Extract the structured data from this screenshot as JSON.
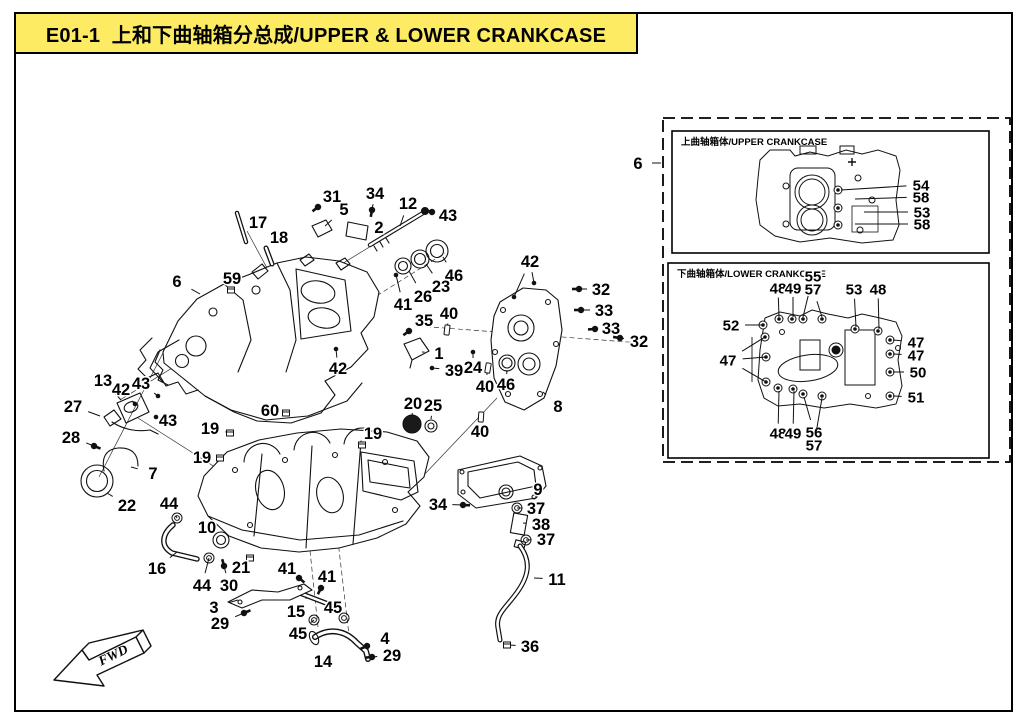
{
  "page": {
    "title": "E01-1  上和下曲轴箱分总成/UPPER & LOWER CRANKCASE",
    "fwd_label": "FWD",
    "colors": {
      "title_bg": "#fdec63",
      "line": "#000000",
      "paper": "#ffffff"
    }
  },
  "main_callouts": [
    {
      "n": "31",
      "x": 332,
      "y": 196,
      "t": [
        [
          318,
          207
        ]
      ],
      "g": "bolt"
    },
    {
      "n": "34",
      "x": 375,
      "y": 193,
      "t": [
        [
          372,
          210
        ]
      ],
      "g": "bolt"
    },
    {
      "n": "12",
      "x": 408,
      "y": 203,
      "t": [
        [
          400,
          226
        ]
      ],
      "g": "none"
    },
    {
      "n": "43",
      "x": 448,
      "y": 215,
      "t": [
        [
          432,
          212
        ]
      ],
      "g": "bolt"
    },
    {
      "n": "5",
      "x": 344,
      "y": 209,
      "t": [
        [
          325,
          226
        ]
      ],
      "g": "none"
    },
    {
      "n": "2",
      "x": 379,
      "y": 227,
      "t": [
        [
          367,
          230
        ]
      ],
      "g": "none"
    },
    {
      "n": "17",
      "x": 258,
      "y": 222,
      "t": [
        [
          247,
          222
        ]
      ],
      "g": "none"
    },
    {
      "n": "18",
      "x": 279,
      "y": 237,
      "t": [
        [
          272,
          250
        ]
      ],
      "g": "none"
    },
    {
      "n": "59",
      "x": 232,
      "y": 278,
      "t": [
        [
          231,
          290
        ]
      ],
      "g": "plug"
    },
    {
      "n": "6",
      "x": 177,
      "y": 281,
      "t": [
        [
          200,
          294
        ]
      ],
      "g": "none"
    },
    {
      "n": "46",
      "x": 454,
      "y": 275,
      "t": [
        [
          443,
          257
        ]
      ],
      "g": "none"
    },
    {
      "n": "23",
      "x": 441,
      "y": 286,
      "t": [
        [
          426,
          264
        ]
      ],
      "g": "none"
    },
    {
      "n": "26",
      "x": 423,
      "y": 296,
      "t": [
        [
          409,
          271
        ]
      ],
      "g": "none"
    },
    {
      "n": "41",
      "x": 403,
      "y": 304,
      "t": [
        [
          396,
          275
        ]
      ],
      "g": "dot"
    },
    {
      "n": "35",
      "x": 424,
      "y": 320,
      "t": [
        [
          409,
          331
        ]
      ],
      "g": "bolt"
    },
    {
      "n": "40",
      "x": 449,
      "y": 313,
      "t": [
        [
          447,
          330
        ]
      ],
      "g": "cyl"
    },
    {
      "n": "1",
      "x": 439,
      "y": 353,
      "t": [
        [
          422,
          352
        ]
      ],
      "g": "none"
    },
    {
      "n": "39",
      "x": 454,
      "y": 370,
      "t": [
        [
          432,
          368
        ]
      ],
      "g": "dot"
    },
    {
      "n": "24",
      "x": 473,
      "y": 367,
      "t": [
        [
          473,
          352
        ]
      ],
      "g": "dot"
    },
    {
      "n": "42",
      "x": 530,
      "y": 261,
      "t": [
        [
          534,
          283
        ],
        [
          514,
          297
        ]
      ],
      "g": "dot"
    },
    {
      "n": "32",
      "x": 601,
      "y": 289,
      "t": [
        [
          579,
          289
        ]
      ],
      "g": "bolt"
    },
    {
      "n": "33",
      "x": 604,
      "y": 310,
      "t": [
        [
          581,
          310
        ]
      ],
      "g": "bolt"
    },
    {
      "n": "33",
      "x": 611,
      "y": 328,
      "t": [
        [
          595,
          329
        ]
      ],
      "g": "bolt"
    },
    {
      "n": "32",
      "x": 639,
      "y": 341,
      "t": [
        [
          620,
          338
        ]
      ],
      "g": "bolt"
    },
    {
      "n": "8",
      "x": 558,
      "y": 406,
      "t": [
        [
          543,
          392
        ]
      ],
      "g": "none"
    },
    {
      "n": "40",
      "x": 485,
      "y": 386,
      "t": [
        [
          488,
          368
        ]
      ],
      "g": "cyl"
    },
    {
      "n": "46",
      "x": 506,
      "y": 384,
      "t": [
        [
          507,
          370
        ]
      ],
      "g": "none"
    },
    {
      "n": "40",
      "x": 480,
      "y": 431,
      "t": [
        [
          481,
          417
        ]
      ],
      "g": "cyl"
    },
    {
      "n": "42",
      "x": 338,
      "y": 368,
      "t": [
        [
          336,
          349
        ]
      ],
      "g": "dot"
    },
    {
      "n": "13",
      "x": 103,
      "y": 380,
      "t": [
        [
          121,
          400
        ]
      ],
      "g": "none"
    },
    {
      "n": "42",
      "x": 121,
      "y": 389,
      "t": [
        [
          135,
          404
        ]
      ],
      "g": "dot"
    },
    {
      "n": "43",
      "x": 141,
      "y": 383,
      "t": [
        [
          158,
          396
        ]
      ],
      "g": "dot"
    },
    {
      "n": "27",
      "x": 73,
      "y": 406,
      "t": [
        [
          100,
          416
        ]
      ],
      "g": "none"
    },
    {
      "n": "43",
      "x": 168,
      "y": 420,
      "t": [
        [
          156,
          417
        ]
      ],
      "g": "dot"
    },
    {
      "n": "28",
      "x": 71,
      "y": 437,
      "t": [
        [
          94,
          446
        ]
      ],
      "g": "bolt"
    },
    {
      "n": "7",
      "x": 153,
      "y": 473,
      "t": [
        [
          131,
          467
        ]
      ],
      "g": "none"
    },
    {
      "n": "22",
      "x": 127,
      "y": 505,
      "t": [
        [
          107,
          493
        ]
      ],
      "g": "none"
    },
    {
      "n": "60",
      "x": 270,
      "y": 410,
      "t": [
        [
          286,
          413
        ]
      ],
      "g": "plug"
    },
    {
      "n": "19",
      "x": 210,
      "y": 428,
      "t": [
        [
          230,
          433
        ]
      ],
      "g": "plug"
    },
    {
      "n": "19",
      "x": 202,
      "y": 457,
      "t": [
        [
          220,
          458
        ]
      ],
      "g": "plug"
    },
    {
      "n": "19",
      "x": 373,
      "y": 433,
      "t": [
        [
          362,
          445
        ]
      ],
      "g": "plug"
    },
    {
      "n": "20",
      "x": 413,
      "y": 403,
      "t": [
        [
          412,
          417
        ]
      ],
      "g": "none"
    },
    {
      "n": "25",
      "x": 433,
      "y": 405,
      "t": [
        [
          431,
          419
        ]
      ],
      "g": "none"
    },
    {
      "n": "44",
      "x": 169,
      "y": 503,
      "t": [
        [
          177,
          518
        ]
      ],
      "g": "ring"
    },
    {
      "n": "16",
      "x": 157,
      "y": 568,
      "t": [
        [
          177,
          552
        ]
      ],
      "g": "none"
    },
    {
      "n": "10",
      "x": 207,
      "y": 527,
      "t": [
        [
          220,
          539
        ]
      ],
      "g": "none"
    },
    {
      "n": "44",
      "x": 202,
      "y": 585,
      "t": [
        [
          209,
          558
        ]
      ],
      "g": "ring"
    },
    {
      "n": "21",
      "x": 241,
      "y": 567,
      "t": [
        [
          250,
          558
        ]
      ],
      "g": "plug"
    },
    {
      "n": "30",
      "x": 229,
      "y": 585,
      "t": [
        [
          224,
          566
        ]
      ],
      "g": "bolt"
    },
    {
      "n": "3",
      "x": 214,
      "y": 607,
      "t": [
        [
          238,
          600
        ]
      ],
      "g": "none"
    },
    {
      "n": "29",
      "x": 220,
      "y": 623,
      "t": [
        [
          244,
          613
        ]
      ],
      "g": "bolt"
    },
    {
      "n": "41",
      "x": 287,
      "y": 568,
      "t": [
        [
          299,
          578
        ]
      ],
      "g": "bolt"
    },
    {
      "n": "41",
      "x": 327,
      "y": 576,
      "t": [
        [
          321,
          588
        ]
      ],
      "g": "bolt"
    },
    {
      "n": "15",
      "x": 296,
      "y": 611,
      "t": [
        [
          307,
          597
        ]
      ],
      "g": "none"
    },
    {
      "n": "45",
      "x": 333,
      "y": 607,
      "t": [
        [
          344,
          618
        ]
      ],
      "g": "ring"
    },
    {
      "n": "45",
      "x": 298,
      "y": 633,
      "t": [
        [
          314,
          620
        ]
      ],
      "g": "ring"
    },
    {
      "n": "14",
      "x": 323,
      "y": 661,
      "t": [
        [
          331,
          648
        ]
      ],
      "g": "none"
    },
    {
      "n": "4",
      "x": 385,
      "y": 638,
      "t": [
        [
          367,
          646
        ]
      ],
      "g": "bolt"
    },
    {
      "n": "29",
      "x": 392,
      "y": 655,
      "t": [
        [
          372,
          657
        ]
      ],
      "g": "bolt"
    },
    {
      "n": "34",
      "x": 438,
      "y": 504,
      "t": [
        [
          463,
          505
        ]
      ],
      "g": "bolt"
    },
    {
      "n": "9",
      "x": 538,
      "y": 489,
      "t": [
        [
          530,
          489
        ]
      ],
      "g": "none"
    },
    {
      "n": "37",
      "x": 536,
      "y": 508,
      "t": [
        [
          517,
          508
        ]
      ],
      "g": "ring"
    },
    {
      "n": "38",
      "x": 541,
      "y": 524,
      "t": [
        [
          523,
          523
        ]
      ],
      "g": "none"
    },
    {
      "n": "37",
      "x": 546,
      "y": 539,
      "t": [
        [
          526,
          540
        ]
      ],
      "g": "ring"
    },
    {
      "n": "11",
      "x": 557,
      "y": 579,
      "t": [
        [
          534,
          578
        ]
      ],
      "g": "none"
    },
    {
      "n": "36",
      "x": 530,
      "y": 646,
      "t": [
        [
          507,
          645
        ]
      ],
      "g": "plug"
    },
    {
      "n": "6",
      "x": 638,
      "y": 163,
      "t": [
        [
          661,
          163
        ]
      ],
      "g": "none"
    }
  ],
  "insets": {
    "upper": {
      "label": "上曲轴箱体/UPPER CRANKCASE",
      "callouts": [
        {
          "n": "54",
          "x": 921,
          "y": 185,
          "t": [
            [
              841,
              190
            ]
          ],
          "g": "none"
        },
        {
          "n": "58",
          "x": 921,
          "y": 197,
          "t": [
            [
              855,
              199
            ]
          ],
          "g": "none"
        },
        {
          "n": "53",
          "x": 922,
          "y": 212,
          "t": [
            [
              864,
              212
            ]
          ],
          "g": "none"
        },
        {
          "n": "58",
          "x": 922,
          "y": 224,
          "t": [
            [
              855,
              224
            ]
          ],
          "g": "none"
        }
      ]
    },
    "lower": {
      "label": "下曲轴箱体/LOWER CRANKCASE",
      "callouts": [
        {
          "n": "52",
          "x": 731,
          "y": 325,
          "t": [
            [
              763,
              325
            ]
          ],
          "g": "none"
        },
        {
          "n": "47",
          "x": 728,
          "y": 360,
          "t": [
            [
              765,
              337
            ],
            [
              766,
              357
            ],
            [
              766,
              382
            ]
          ],
          "g": "none"
        },
        {
          "n": "48",
          "x": 778,
          "y": 288,
          "t": [
            [
              779,
              317
            ]
          ],
          "g": "none"
        },
        {
          "n": "49",
          "x": 793,
          "y": 288,
          "t": [
            [
              793,
              317
            ]
          ],
          "g": "none"
        },
        {
          "n": "55",
          "x": 813,
          "y": 276,
          "t": [
            [
              803,
              317
            ]
          ],
          "g": "none"
        },
        {
          "n": "57",
          "x": 813,
          "y": 289,
          "t": [
            [
              822,
              317
            ]
          ],
          "g": "none"
        },
        {
          "n": "53",
          "x": 854,
          "y": 289,
          "t": [
            [
              856,
              327
            ]
          ],
          "g": "none"
        },
        {
          "n": "48",
          "x": 878,
          "y": 289,
          "t": [
            [
              879,
              329
            ]
          ],
          "g": "none"
        },
        {
          "n": "47",
          "x": 916,
          "y": 342,
          "t": [
            [
              893,
              340
            ]
          ],
          "g": "none"
        },
        {
          "n": "47",
          "x": 916,
          "y": 355,
          "t": [
            [
              893,
              354
            ]
          ],
          "g": "none"
        },
        {
          "n": "50",
          "x": 918,
          "y": 372,
          "t": [
            [
              893,
              372
            ]
          ],
          "g": "none"
        },
        {
          "n": "51",
          "x": 916,
          "y": 397,
          "t": [
            [
              893,
              396
            ]
          ],
          "g": "none"
        },
        {
          "n": "48",
          "x": 778,
          "y": 433,
          "t": [
            [
              779,
              391
            ]
          ],
          "g": "none"
        },
        {
          "n": "49",
          "x": 793,
          "y": 433,
          "t": [
            [
              794,
              391
            ]
          ],
          "g": "none"
        },
        {
          "n": "56",
          "x": 814,
          "y": 432,
          "t": [
            [
              804,
              397
            ]
          ],
          "g": "none"
        },
        {
          "n": "57",
          "x": 814,
          "y": 445,
          "t": [
            [
              822,
              398
            ]
          ],
          "g": "none"
        }
      ]
    }
  }
}
